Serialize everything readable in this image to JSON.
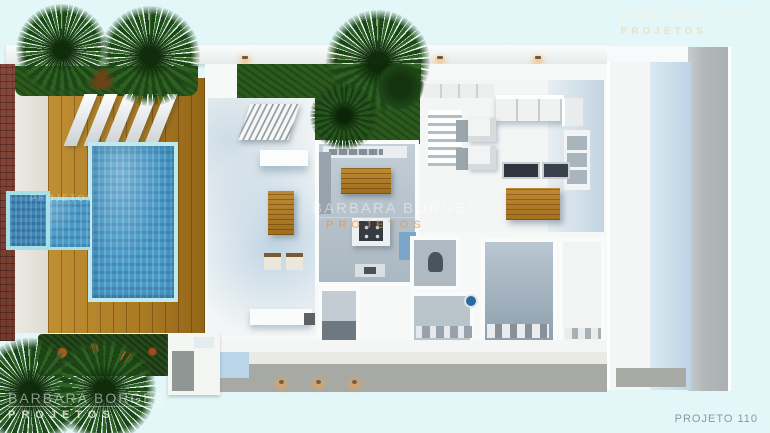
{
  "brand": {
    "name": "BARBARA BORGES",
    "division": "PROJETOS"
  },
  "watermarks": {
    "top_right": {
      "line1": "BARBARA BORGES",
      "line2": "PROJETOS"
    },
    "center": {
      "line1": "BARBARA BORGES",
      "line2": "PROJETOS"
    },
    "bottom_left": {
      "line1": "BARBARA BORGES",
      "line2": "PROJETOS"
    },
    "pool_faint": {
      "line1": "PROJETOS"
    },
    "bottom_right": {
      "label": "PROJETO 110"
    }
  },
  "colors": {
    "background": "#e3f6f8",
    "pool_water": "#4a9ac8",
    "spa_water": "#3f86b5",
    "pool_coping": "#a5e0e6",
    "deck_wood": "#aa7a24",
    "brick_wall": "#7c4134",
    "palm_green": "#1d4517",
    "garden_green": "#2b5a1d",
    "wall_white": "#fafcfc",
    "floor_gray": "#b9c6ce",
    "floor_blue": "#c2d4e2",
    "furniture_wood": "#b5812f",
    "walkway_gray": "#a7aaa4",
    "roof_strip_gray": "#b2b8ba",
    "flower_accent": "#c05a22",
    "light_glow": "#f0a050"
  }
}
